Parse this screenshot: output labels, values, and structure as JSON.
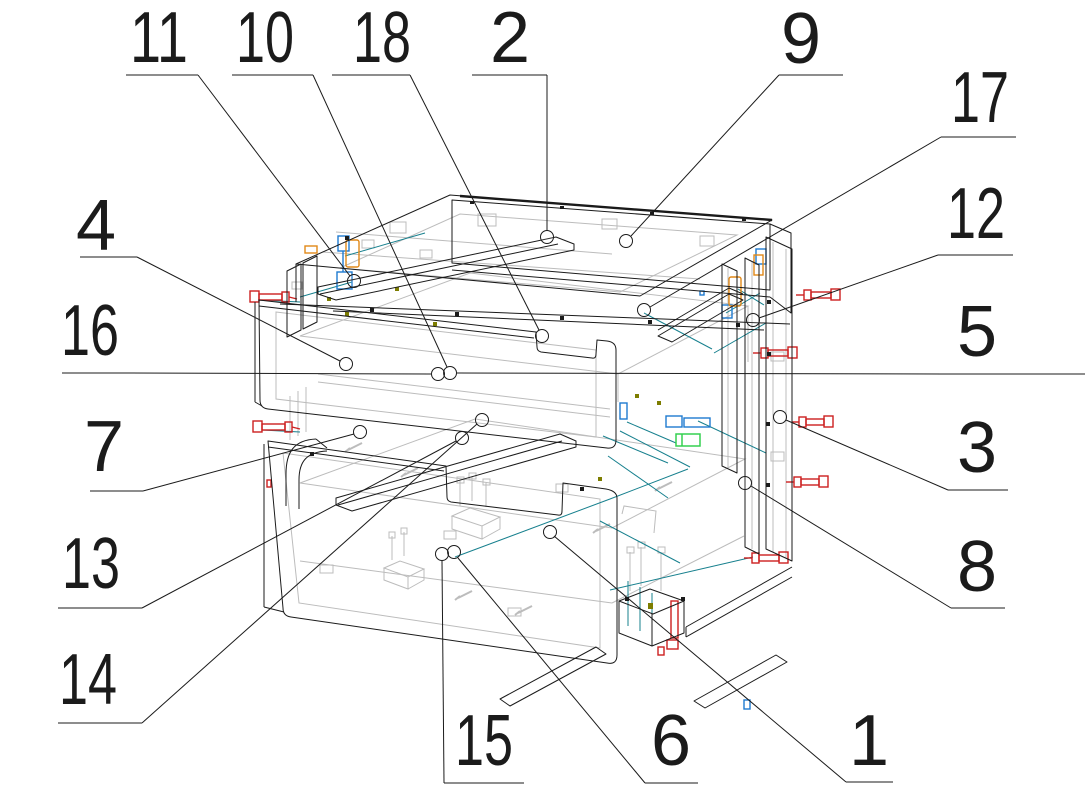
{
  "drawing": {
    "background": "#ffffff",
    "outline_color": "#1b1b1b",
    "hidden_line_color": "#bcbcbc",
    "accent_colors": {
      "screw_red": "#cc2020",
      "fitting_blue": "#1e7ad0",
      "fitting_orange": "#e08818",
      "fitting_green": "#35d050",
      "connector_teal": "#17808e",
      "cam_olive": "#7d7d00"
    },
    "callout_circle_radius": 6.5
  },
  "callouts": [
    {
      "n": "1",
      "label_x": 869,
      "label_y": 741,
      "underline": [
        846,
        782,
        893,
        782
      ],
      "leader": [
        846,
        782,
        554,
        536
      ],
      "circle": {
        "x": 550,
        "y": 532
      }
    },
    {
      "n": "2",
      "label_x": 510,
      "label_y": 38,
      "underline": [
        472,
        75,
        547,
        75
      ],
      "leader": [
        547,
        75,
        547,
        231
      ],
      "circle": {
        "x": 547,
        "y": 237
      }
    },
    {
      "n": "3",
      "label_x": 977,
      "label_y": 448,
      "underline": [
        948,
        490,
        1008,
        490
      ],
      "leader": [
        948,
        490,
        786,
        420
      ],
      "circle": {
        "x": 780,
        "y": 417
      }
    },
    {
      "n": "4",
      "label_x": 96,
      "label_y": 226,
      "underline": [
        80,
        257,
        137,
        257
      ],
      "leader": [
        137,
        257,
        340,
        361
      ],
      "circle": {
        "x": 346,
        "y": 364
      }
    },
    {
      "n": "5",
      "label_x": 977,
      "label_y": 332,
      "underline": [
        1085,
        374,
        945,
        374
      ],
      "leader": [
        945,
        374,
        457,
        373
      ],
      "circle": null
    },
    {
      "n": "6",
      "label_x": 671,
      "label_y": 741,
      "underline": [
        645,
        783,
        698,
        783
      ],
      "leader": [
        645,
        783,
        458,
        558
      ],
      "circle": {
        "x": 454,
        "y": 552
      }
    },
    {
      "n": "7",
      "label_x": 104,
      "label_y": 447,
      "underline": [
        90,
        491,
        143,
        491
      ],
      "leader": [
        143,
        491,
        354,
        434
      ],
      "circle": {
        "x": 360,
        "y": 432
      }
    },
    {
      "n": "8",
      "label_x": 977,
      "label_y": 567,
      "underline": [
        951,
        608,
        1005,
        608
      ],
      "leader": [
        951,
        608,
        751,
        486
      ],
      "circle": {
        "x": 745,
        "y": 483
      }
    },
    {
      "n": "9",
      "label_x": 801,
      "label_y": 39,
      "underline": [
        779,
        75,
        843,
        75
      ],
      "leader": [
        779,
        75,
        631,
        236
      ],
      "circle": {
        "x": 626,
        "y": 241
      }
    },
    {
      "n": "10",
      "label_x": 265,
      "label_y": 38,
      "underline": [
        232,
        75,
        313,
        75
      ],
      "leader": [
        313,
        75,
        447,
        367
      ],
      "circle": {
        "x": 450,
        "y": 373
      }
    },
    {
      "n": "11",
      "label_x": 159,
      "label_y": 38,
      "underline": [
        126,
        75,
        198,
        75
      ],
      "leader": [
        198,
        75,
        350,
        276
      ],
      "circle": {
        "x": 354,
        "y": 281
      }
    },
    {
      "n": "12",
      "label_x": 976,
      "label_y": 214,
      "underline": [
        938,
        255,
        1013,
        255
      ],
      "leader": [
        938,
        255,
        759,
        318
      ],
      "circle": {
        "x": 753,
        "y": 320
      }
    },
    {
      "n": "13",
      "label_x": 91,
      "label_y": 564,
      "underline": [
        58,
        608,
        142,
        608
      ],
      "leader": [
        142,
        608,
        456,
        441
      ],
      "circle": {
        "x": 462,
        "y": 438
      }
    },
    {
      "n": "14",
      "label_x": 88,
      "label_y": 680,
      "underline": [
        58,
        723,
        142,
        723
      ],
      "leader": [
        142,
        723,
        477,
        424
      ],
      "circle": {
        "x": 482,
        "y": 420
      }
    },
    {
      "n": "15",
      "label_x": 484,
      "label_y": 741,
      "underline": [
        444,
        783,
        524,
        783
      ],
      "leader": [
        444,
        783,
        442,
        561
      ],
      "circle": {
        "x": 442,
        "y": 554
      }
    },
    {
      "n": "16",
      "label_x": 90,
      "label_y": 331,
      "underline": [
        62,
        373,
        130,
        373
      ],
      "leader": [
        130,
        373,
        431,
        374
      ],
      "circle": {
        "x": 438,
        "y": 374
      }
    },
    {
      "n": "17",
      "label_x": 980,
      "label_y": 98,
      "underline": [
        941,
        137,
        1016,
        137
      ],
      "leader": [
        941,
        137,
        650,
        307
      ],
      "circle": {
        "x": 644,
        "y": 310
      }
    },
    {
      "n": "18",
      "label_x": 382,
      "label_y": 38,
      "underline": [
        332,
        75,
        410,
        75
      ],
      "leader": [
        410,
        75,
        539,
        330
      ],
      "circle": {
        "x": 542,
        "y": 336
      }
    }
  ]
}
